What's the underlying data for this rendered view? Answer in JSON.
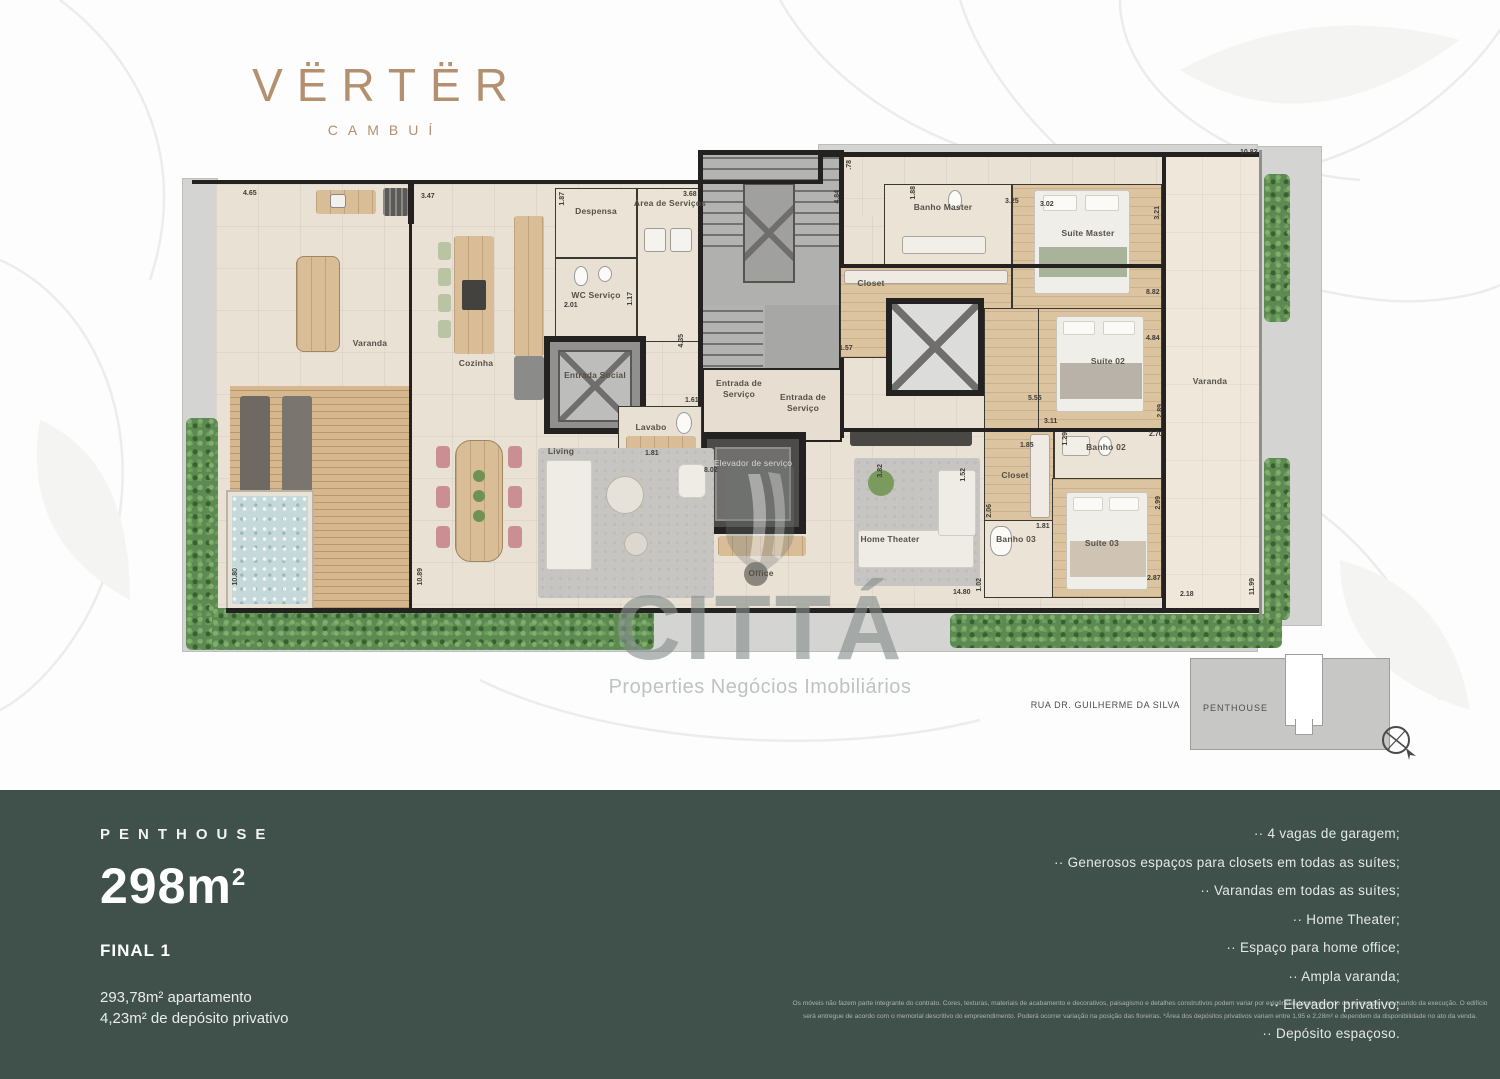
{
  "logo": {
    "brand": "VËRTËR",
    "sub": "CAMBUÍ"
  },
  "colors": {
    "accent": "#B3906F",
    "footer_bg": "#40504A",
    "hedge_green": "#5D8A52",
    "pool_blue": "#C6D9DA"
  },
  "plan": {
    "rooms": {
      "varanda_left": "Varanda",
      "cozinha": "Cozinha",
      "despensa": "Despensa",
      "area_servicos": "Área de Serviços",
      "wc_servico": "WC Serviço",
      "entrada_social": "Entrada Social",
      "entrada_servico": "Entrada de Serviço",
      "entrada_servico2": "Entrada de Serviço",
      "lavabo": "Lavabo",
      "living": "Living",
      "elevador_servico": "Elevador de serviço",
      "office": "Office",
      "home_theater": "Home Theater",
      "banho_master": "Banho Master",
      "closet_master": "Closet",
      "suite_master": "Suíte Master",
      "suite_02": "Suíte 02",
      "banho_02": "Banho 02",
      "closet_03": "Closet",
      "banho_03": "Banho 03",
      "suite_03": "Suíte 03",
      "varanda_right": "Varanda"
    },
    "dims": [
      "4.65",
      "3.47",
      "1.87",
      "3.68",
      ".78",
      "4.84",
      "1.88",
      "3.25",
      "3.02",
      "3.21",
      "10.83",
      "2.01",
      "1.17",
      "4.35",
      "1.61",
      "1.57",
      "8.82",
      "4.84",
      "5.55",
      "3.11",
      "1.29",
      "1.85",
      "2.70",
      "2.89",
      "2.99",
      "1.52",
      "2.06",
      "3.82",
      "1.81",
      "8.02",
      "1.81",
      "2.87",
      "2.18",
      "11.99",
      "14.80",
      "1.02",
      "10.80",
      "10.89"
    ]
  },
  "watermark": {
    "brand": "CITTÁ",
    "tagline": "Properties Negócios Imobiliários"
  },
  "keyplan": {
    "street": "RUA DR. GUILHERME DA SILVA",
    "unit": "PENTHOUSE"
  },
  "footer": {
    "label": "PENTHOUSE",
    "area_value": "298m",
    "area_exp": "2",
    "final": "FINAL 1",
    "line1": "293,78m² apartamento",
    "line2": "4,23m² de depósito privativo",
    "amenities": [
      "·· 4 vagas de garagem;",
      "·· Generosos espaços para closets em todas as suítes;",
      "·· Varandas em todas as suítes;",
      "·· Home Theater;",
      "·· Espaço para home office;",
      "·· Ampla varanda;",
      "·· Elevador privativo;",
      "·· Depósito espaçoso."
    ],
    "disclaimer": "Os móveis não fazem parte integrante do contrato. Cores, texturas, materiais de acabamento e decorativos, paisagismo e detalhes construtivos podem variar por exigências legais quando da aprovação, ou quando da execução. O edifício será entregue de acordo com o memorial descritivo do empreendimento. Poderá ocorrer variação na posição das floreiras. *Área dos depósitos privativos variam entre 1,95 e 2,28m² e dependem da disponibilidade no ato da venda."
  }
}
